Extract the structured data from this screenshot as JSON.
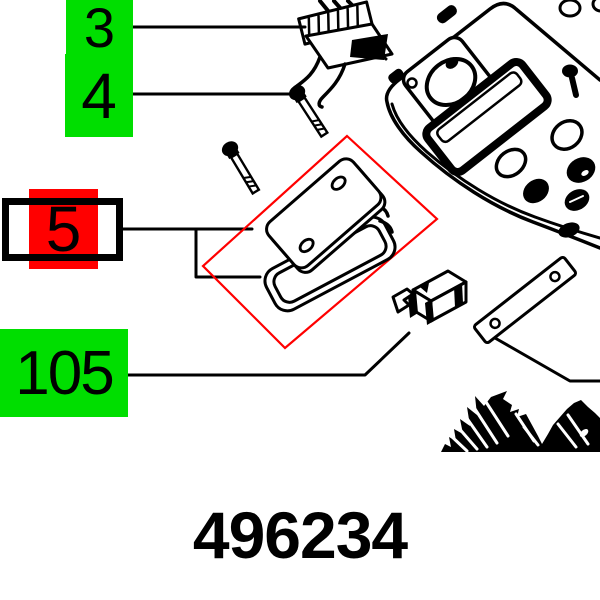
{
  "drawing_number": "496234",
  "callouts": [
    {
      "label": "3",
      "highlight": "green",
      "selected": false
    },
    {
      "label": "4",
      "highlight": "green",
      "selected": false
    },
    {
      "label": "5",
      "highlight": "red",
      "selected": true
    },
    {
      "label": "105",
      "highlight": "green",
      "selected": false
    }
  ],
  "colors": {
    "highlight_green": "#00DE00",
    "highlight_red": "#FF0000",
    "focus_frame_red": "#FF0000",
    "line_art": "#000000",
    "background": "#FFFFFF"
  }
}
